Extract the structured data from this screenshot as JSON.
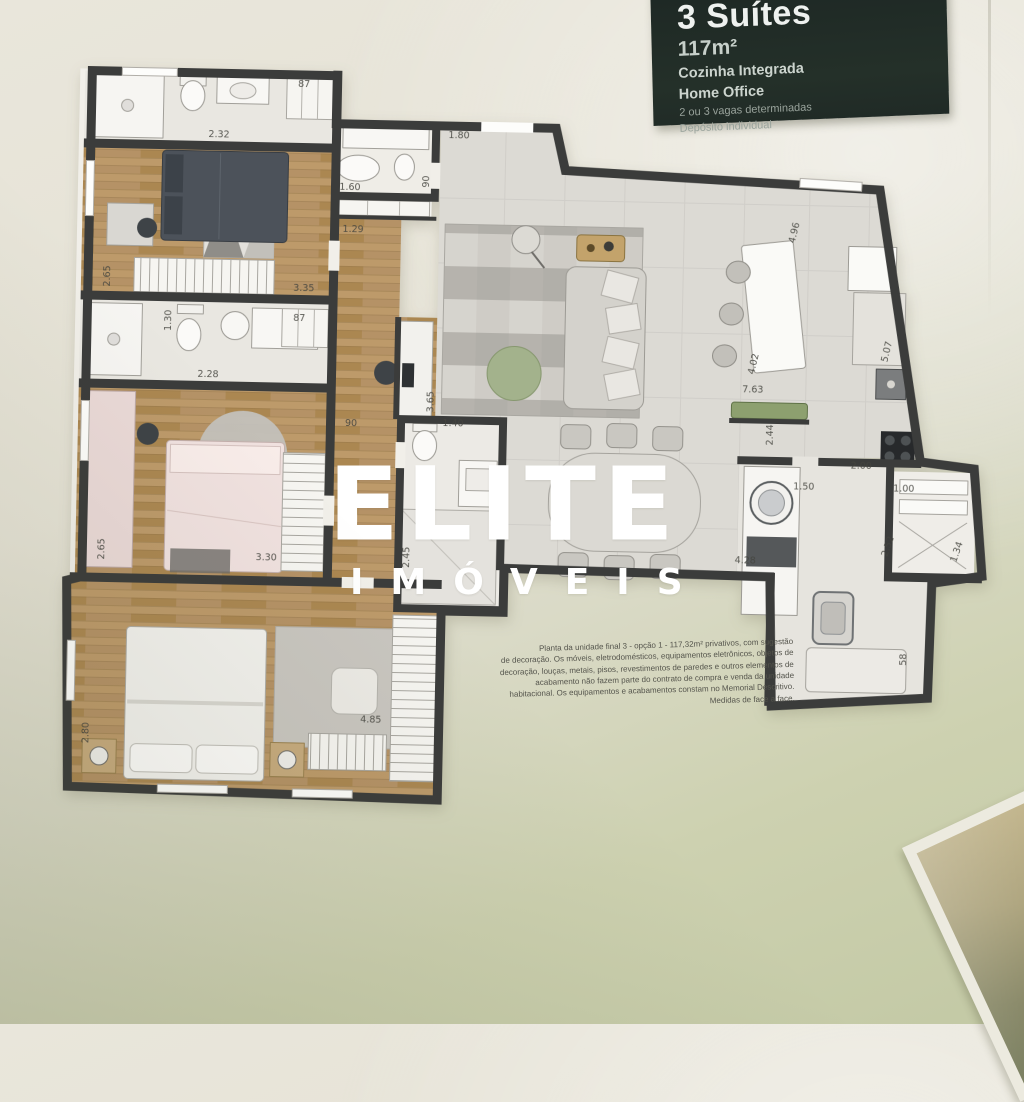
{
  "info_card": {
    "title": "3 Suítes",
    "area": "117m²",
    "feature1": "Cozinha Integrada",
    "feature2": "Home Office",
    "note1": "2 ou 3 vagas determinadas",
    "note2": "Depósito individual"
  },
  "watermark": {
    "brand": "ELITE",
    "sub": "IMÓVEIS"
  },
  "disclaimer": "Planta da unidade final 3 - opção 1 - 117,32m² privativos, com sugestão\nde decoração. Os móveis, eletrodomésticos, equipamentos eletrônicos, objetos de\ndecoração, louças, metais, pisos, revestimentos de paredes e outros elementos de\nacabamento não fazem parte do contrato de compra e venda da unidade\nhabitacional. Os equipamentos e acabamentos constam no Memorial Descritivo.\nMedidas de face a face.",
  "plan": {
    "wall_color": "#3b3c3b",
    "dimensions": [
      {
        "label": "2.32",
        "x": 168,
        "y": 74,
        "rot": 0
      },
      {
        "label": "87",
        "x": 252,
        "y": 22,
        "rot": 0
      },
      {
        "label": "2.65",
        "x": 62,
        "y": 215,
        "rot": -90
      },
      {
        "label": "3.35",
        "x": 256,
        "y": 226,
        "rot": 0
      },
      {
        "label": "1.30",
        "x": 124,
        "y": 258,
        "rot": -90
      },
      {
        "label": "2.28",
        "x": 162,
        "y": 314,
        "rot": 0
      },
      {
        "label": "87",
        "x": 252,
        "y": 256,
        "rot": 0
      },
      {
        "label": "2.65",
        "x": 62,
        "y": 488,
        "rot": -90
      },
      {
        "label": "3.30",
        "x": 224,
        "y": 496,
        "rot": 0
      },
      {
        "label": "2.80",
        "x": 50,
        "y": 672,
        "rot": -90
      },
      {
        "label": "4.85",
        "x": 332,
        "y": 656,
        "rot": 0
      },
      {
        "label": "1.60",
        "x": 300,
        "y": 124,
        "rot": 0
      },
      {
        "label": "1.29",
        "x": 304,
        "y": 166,
        "rot": 0
      },
      {
        "label": "90",
        "x": 306,
        "y": 360,
        "rot": 0
      },
      {
        "label": "90",
        "x": 379,
        "y": 114,
        "rot": -90
      },
      {
        "label": "1.80",
        "x": 408,
        "y": 70,
        "rot": 0
      },
      {
        "label": "3.65",
        "x": 388,
        "y": 334,
        "rot": -90
      },
      {
        "label": "1.40",
        "x": 408,
        "y": 358,
        "rot": 0
      },
      {
        "label": "2.45",
        "x": 367,
        "y": 490,
        "rot": -90
      },
      {
        "label": "4.96",
        "x": 748,
        "y": 158,
        "rot": -78
      },
      {
        "label": "4.02",
        "x": 710,
        "y": 290,
        "rot": -78
      },
      {
        "label": "7.63",
        "x": 707,
        "y": 318,
        "rot": 0
      },
      {
        "label": "2.44",
        "x": 728,
        "y": 360,
        "rot": -90
      },
      {
        "label": "5.07",
        "x": 843,
        "y": 275,
        "rot": -78
      },
      {
        "label": "2.00",
        "x": 817,
        "y": 392,
        "rot": 0
      },
      {
        "label": "1.50",
        "x": 760,
        "y": 414,
        "rot": 0
      },
      {
        "label": "1.00",
        "x": 860,
        "y": 414,
        "rot": 0
      },
      {
        "label": "2.52",
        "x": 848,
        "y": 470,
        "rot": -72
      },
      {
        "label": "1.34",
        "x": 917,
        "y": 474,
        "rot": -72
      },
      {
        "label": "4.28",
        "x": 703,
        "y": 489,
        "rot": 0
      },
      {
        "label": "58",
        "x": 866,
        "y": 582,
        "rot": -90
      }
    ]
  }
}
